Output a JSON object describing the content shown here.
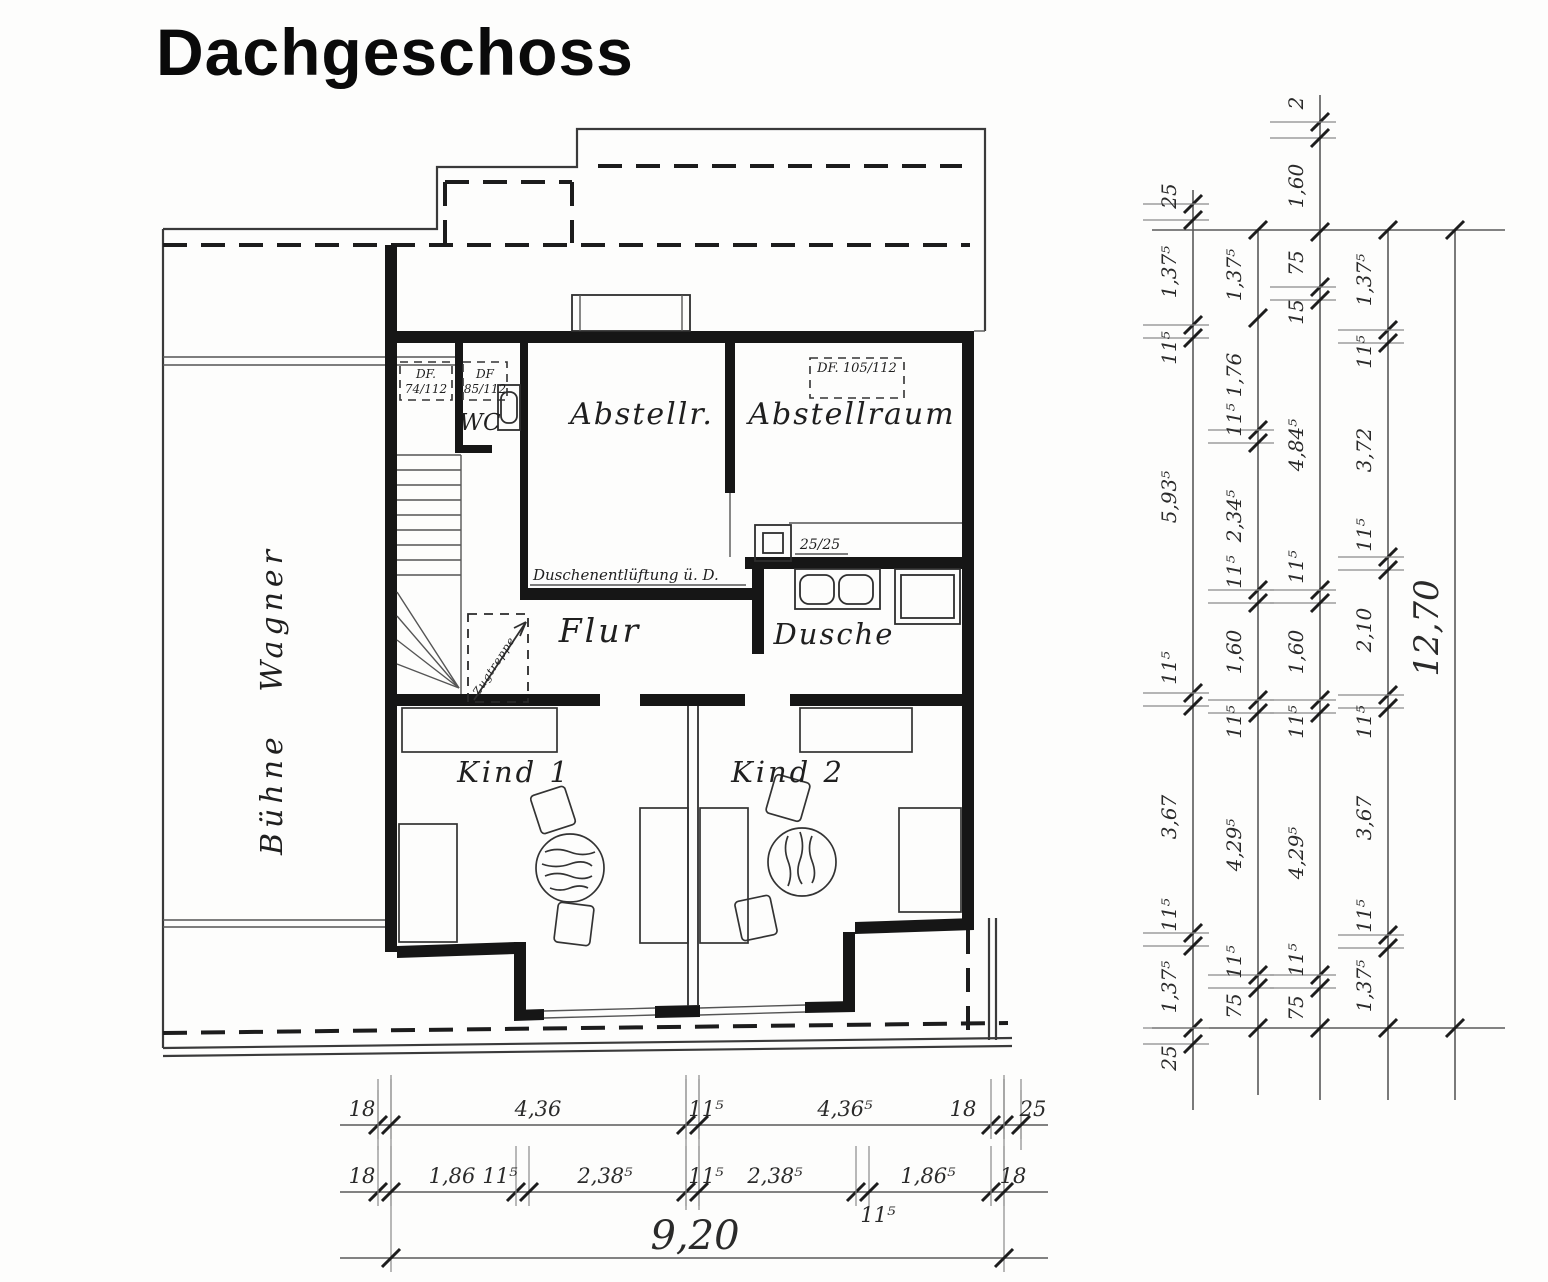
{
  "title": "Dachgeschoss",
  "plan": {
    "room_labels": {
      "buehne": "Bühne Wagner",
      "wc": "WC",
      "abstellr": "Abstellr.",
      "abstellraum": "Abstellraum",
      "flur": "Flur",
      "dusche": "Dusche",
      "kind1": "Kind 1",
      "kind2": "Kind 2"
    },
    "annotations": {
      "df1_line1": "DF.",
      "df1_line2": "74/112",
      "df2_line1": "DF",
      "df2_line2": "85/112",
      "df3": "DF. 105/112",
      "duct": "25/25",
      "vent": "Duschenentlüftung ü. D.",
      "ladder": "Zugtreppe"
    }
  },
  "dims": {
    "right": {
      "c1": [
        "25",
        "1,37⁵",
        "11⁵",
        "5,93⁵",
        "11⁵",
        "3,67",
        "11⁵",
        "1,37⁵",
        "25"
      ],
      "c2": [
        "1,37⁵",
        "1,76",
        "11⁵",
        "2,34⁵",
        "11⁵",
        "1,60",
        "11⁵",
        "4,29⁵",
        "11⁵",
        "75"
      ],
      "c3": [
        "2",
        "1,60",
        "75",
        "15",
        "4,84⁵",
        "11⁵",
        "1,60",
        "11⁵",
        "4,29⁵",
        "11⁵",
        "75"
      ],
      "c4": [
        "1,37⁵",
        "11⁵",
        "3,72",
        "11⁵",
        "2,10",
        "11⁵",
        "3,67",
        "11⁵",
        "1,37⁵"
      ],
      "c5": [
        "12,70"
      ]
    },
    "bottom": {
      "r1": [
        "18",
        "4,36",
        "11⁵",
        "4,36⁵",
        "18",
        "25"
      ],
      "r2": [
        "18",
        "1,86",
        "11⁵",
        "2,38⁵",
        "11⁵",
        "2,38⁵",
        "11⁵",
        "1,86⁵",
        "18"
      ],
      "r3": [
        "9,20"
      ]
    }
  }
}
